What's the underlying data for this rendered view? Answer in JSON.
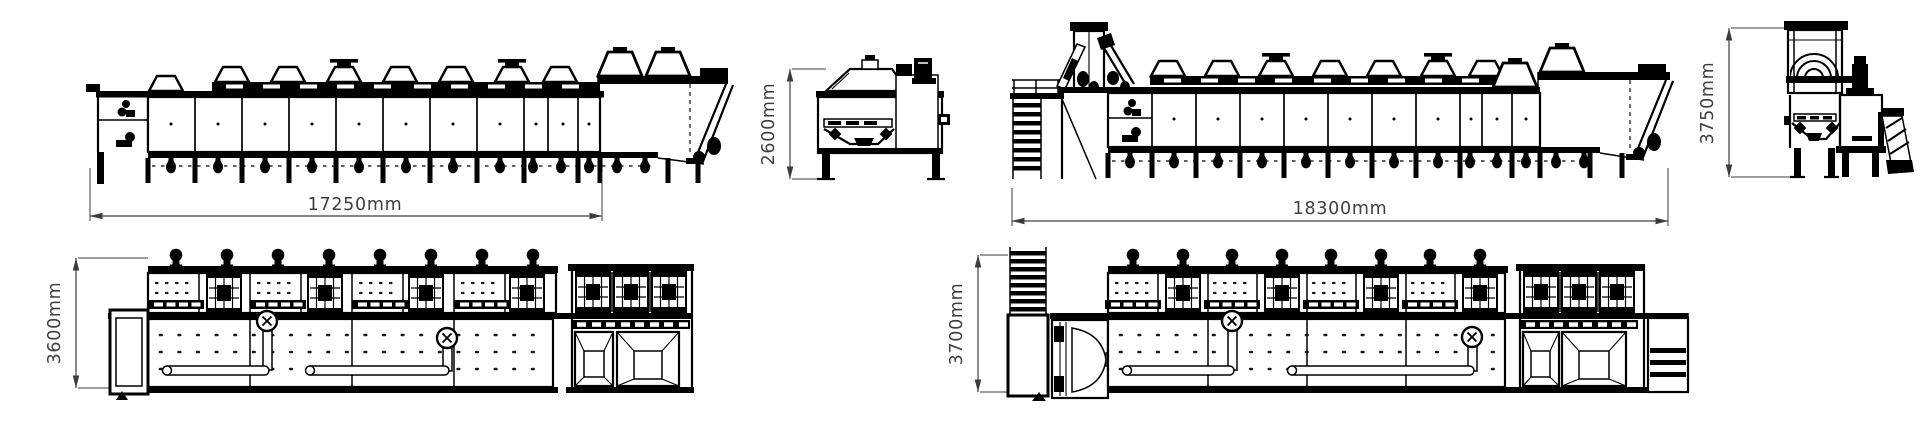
{
  "colors": {
    "ink": "#000000",
    "dimension": "#3c3c3c",
    "background": "#ffffff"
  },
  "dimensions": {
    "side_a_length": "17250mm",
    "end_a_height": "2600mm",
    "side_b_length": "18300mm",
    "end_b_height": "3750mm",
    "plan_a_width": "3600mm",
    "plan_b_width": "3700mm"
  }
}
